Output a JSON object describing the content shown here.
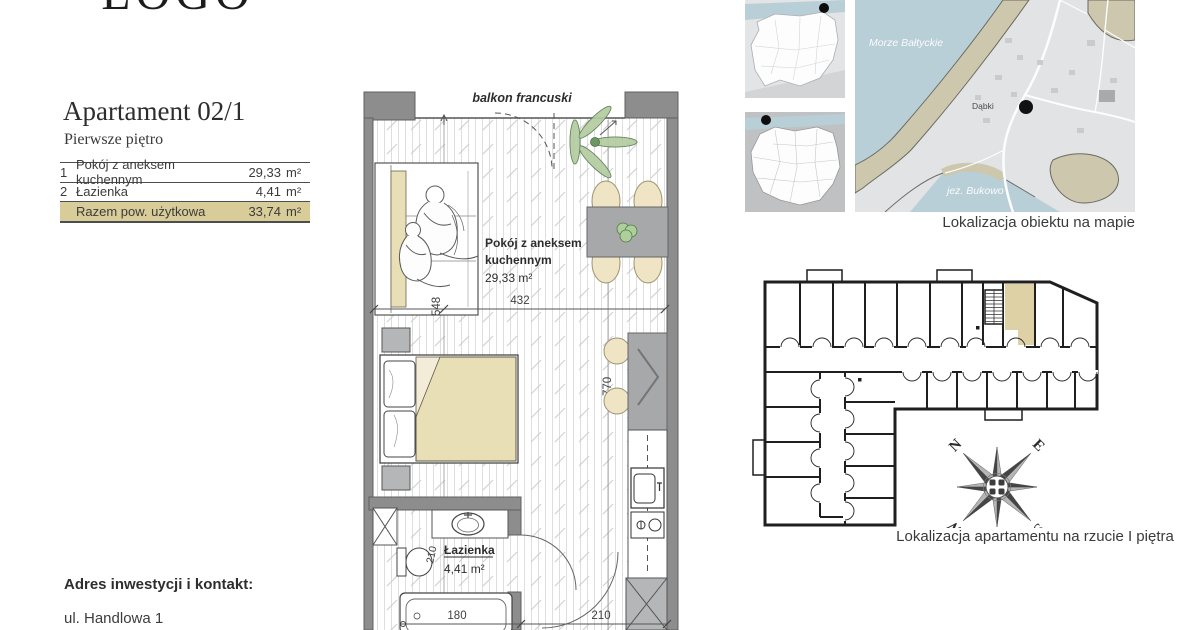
{
  "logo": {
    "text": "LOGO"
  },
  "header": {
    "title": "Apartament 02/1",
    "subtitle": "Pierwsze piętro"
  },
  "area_table": {
    "rows": [
      {
        "num": "1",
        "name": "Pokój z aneksem kuchennym",
        "value": "29,33",
        "unit": "m²"
      },
      {
        "num": "2",
        "name": "Łazienka",
        "value": "4,41",
        "unit": "m²"
      }
    ],
    "total_label": "Razem pow. użytkowa",
    "total_value": "33,74",
    "total_unit": "m²"
  },
  "contact": {
    "heading": "Adres inwestycji i kontakt:",
    "address_line": "ul. Handlowa 1"
  },
  "floor_plan": {
    "balcony_label": "balkon francuski",
    "living_room": {
      "label_line1": "Pokój z aneksem",
      "label_line2": "kuchennym",
      "area": "29,33 m²"
    },
    "bathroom": {
      "label": "Łazienka",
      "area": "4,41 m²"
    },
    "dimensions": {
      "room_width": "432",
      "room_depth": "548",
      "kitchen_depth": "770",
      "bath_depth": "210",
      "tub_width": "180",
      "entry_width": "210"
    }
  },
  "location_map": {
    "sea_label": "Morze Bałtyckie",
    "town_label": "Dąbki",
    "lake_label": "jez. Bukowo",
    "caption": "Lokalizacja obiektu na mapie"
  },
  "building_plan": {
    "caption": "Lokalizacja apartamentu na rzucie I piętra"
  },
  "compass": {
    "north": "N",
    "east": "E",
    "south": "S",
    "west": "W"
  },
  "colors": {
    "highlight_row": "#d8cc99",
    "unit_highlight": "#ddd1a5",
    "wall_gray": "#8d8d8d",
    "accent_tan": "#e8dfb6",
    "sea_blue": "#b8cfd8"
  }
}
